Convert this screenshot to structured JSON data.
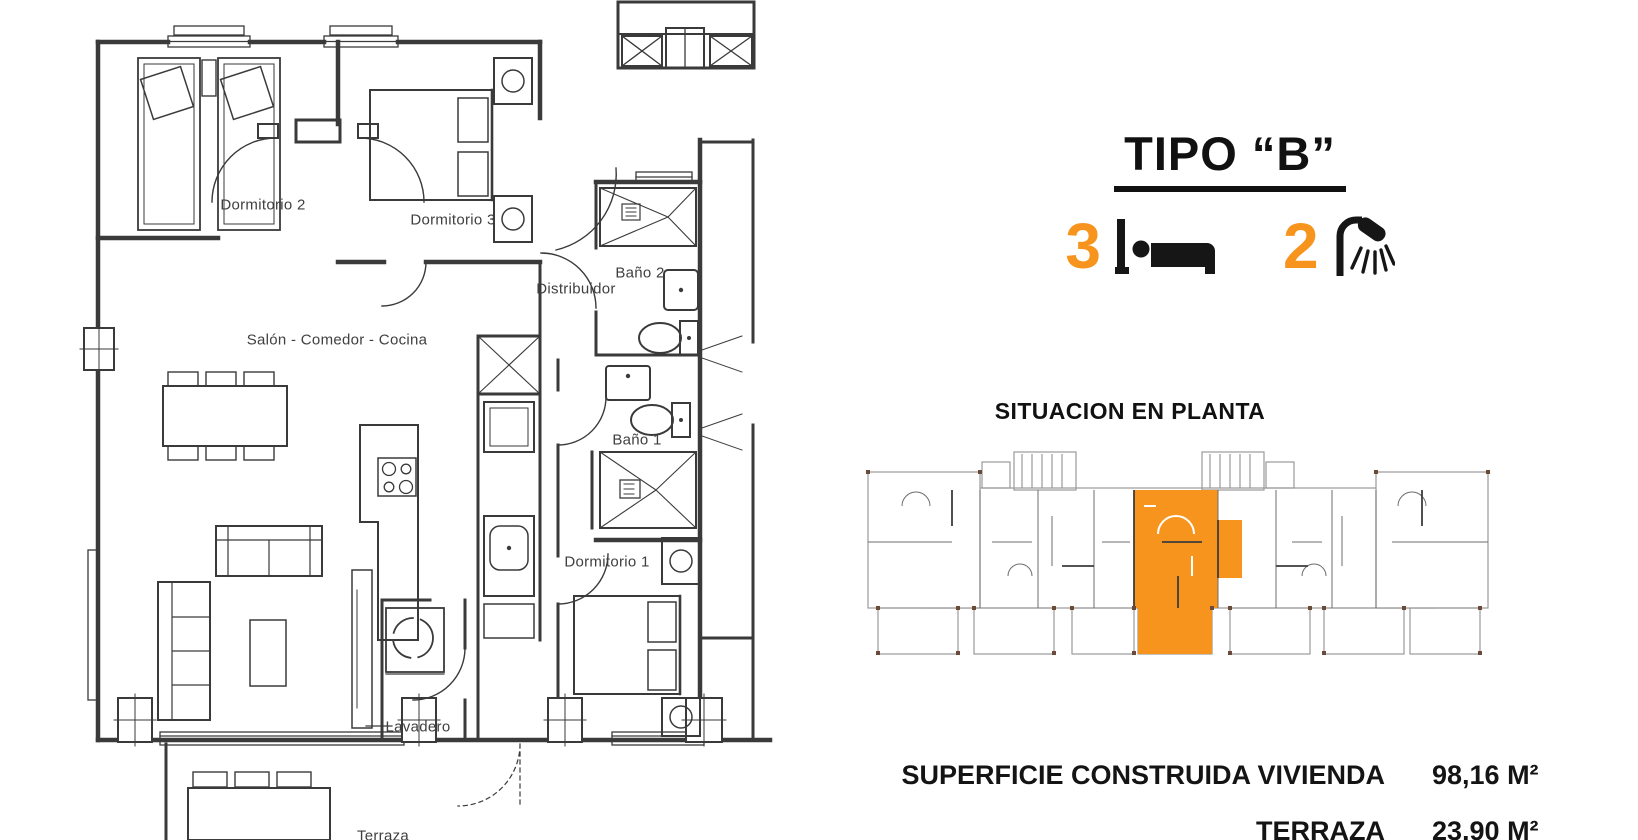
{
  "accent_color": "#F7941D",
  "header": {
    "title": "TIPO “B”"
  },
  "features": {
    "bedrooms": {
      "count": "3",
      "icon": "bed-icon"
    },
    "bathrooms": {
      "count": "2",
      "icon": "shower-icon"
    }
  },
  "situation": {
    "heading": "SITUACION EN PLANTA"
  },
  "areas": [
    {
      "label": "SUPERFICIE CONSTRUIDA VIVIENDA",
      "value": "98,16 M²"
    },
    {
      "label": "TERRAZA",
      "value": "23,90 M²"
    }
  ],
  "floor_plan": {
    "rooms": {
      "dormitorio2": "Dormitorio 2",
      "dormitorio3": "Dormitorio 3",
      "distribuidor": "Distribuidor",
      "bano2": "Baño 2",
      "salon": "Salón - Comedor - Cocina",
      "bano1": "Baño 1",
      "dormitorio1": "Dormitorio 1",
      "lavadero": "Lavadero",
      "terraza": "Terraza"
    }
  }
}
